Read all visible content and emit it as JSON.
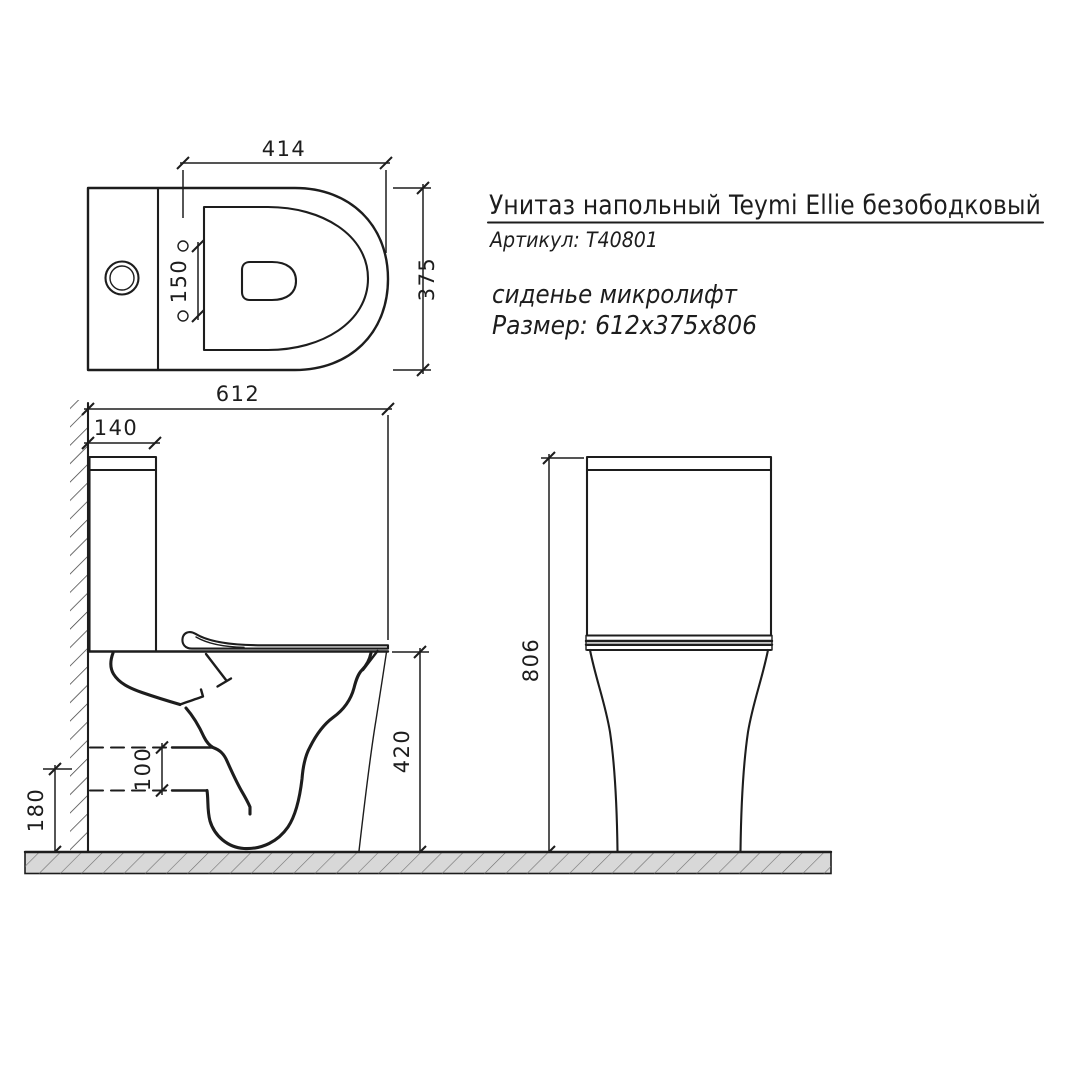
{
  "drawing": {
    "title": "Унитаз напольный Teymi Ellie безободковый",
    "article": "Артикул: Т40801",
    "seat_note": "сиденье микролифт",
    "size_note": "Размер: 612х375х806"
  },
  "dimensions": {
    "seat_length": "414",
    "bowl_width": "375",
    "hole_spacing": "150",
    "total_depth": "612",
    "tank_depth": "140",
    "outlet_diameter": "100",
    "outlet_height": "180",
    "rim_height": "420",
    "total_height": "806"
  },
  "colors": {
    "background": "#ffffff",
    "line": "#1d1d1d",
    "hatch_fill": "#d8d8d8",
    "hatch_stroke": "#707070",
    "wall_hatch": "#3f3f3f"
  }
}
